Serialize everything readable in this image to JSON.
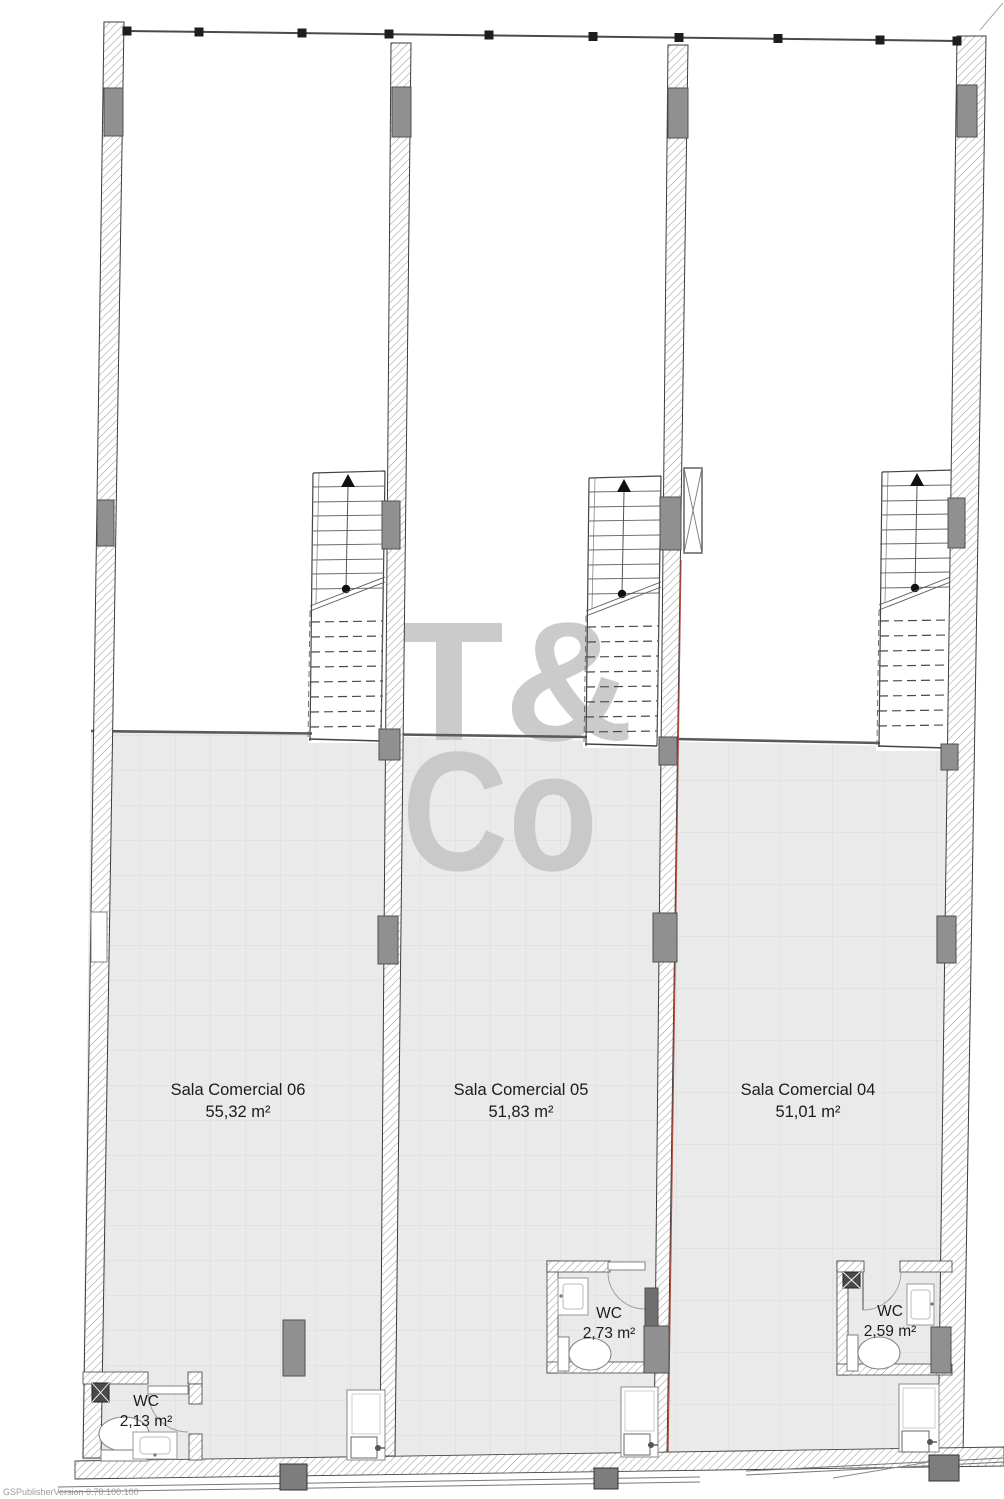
{
  "plan": {
    "rooms": [
      {
        "name": "Sala Comercial 06",
        "area": "55,32 m²"
      },
      {
        "name": "Sala Comercial 05",
        "area": "51,83 m²"
      },
      {
        "name": "Sala Comercial 04",
        "area": "51,01 m²"
      }
    ],
    "wcs": [
      {
        "label": "WC",
        "area": "2,13 m²"
      },
      {
        "label": "WC",
        "area": "2,73 m²"
      },
      {
        "label": "WC",
        "area": "2,59 m²"
      }
    ],
    "watermark": {
      "line1": "T&",
      "line2": "Co"
    },
    "footer": {
      "version": "GSPublisherVersion 0.78.100.100"
    },
    "colors": {
      "floor": "#eaeaea",
      "tile_grid": "#d9d9d9",
      "hatch": "#8a8a8a",
      "column": "#909090",
      "marker": "#1e1e1e",
      "watermark": "#c6c6c6",
      "accent_red": "#b04a3a",
      "text": "#1c1c1c"
    }
  }
}
